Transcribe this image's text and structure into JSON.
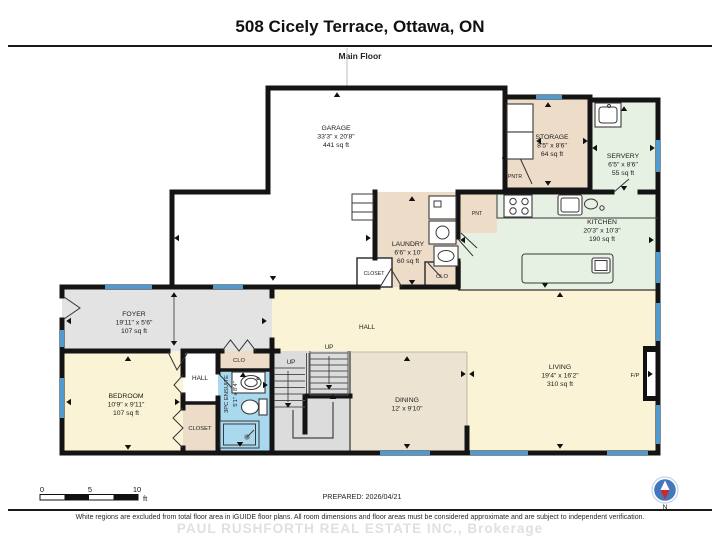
{
  "header": {
    "title": "508 Cicely Terrace, Ottawa, ON",
    "floor_label": "Main Floor"
  },
  "rooms": {
    "garage": {
      "name": "GARAGE",
      "dims": "33'3\" x 20'8\"",
      "area": "441 sq ft"
    },
    "storage": {
      "name": "STORAGE",
      "dims": "8'5\" x 8'6\"",
      "area": "64 sq ft"
    },
    "servery": {
      "name": "SERVERY",
      "dims": "6'5\" x 8'6\"",
      "area": "55 sq ft"
    },
    "kitchen": {
      "name": "KITCHEN",
      "dims": "20'3\" x 10'3\"",
      "area": "190 sq ft"
    },
    "laundry": {
      "name": "LAUNDRY",
      "dims": "6'6\" x 10'",
      "area": "60 sq ft"
    },
    "foyer": {
      "name": "FOYER",
      "dims": "19'11\" x 5'6\"",
      "area": "107 sq ft"
    },
    "bedroom": {
      "name": "BEDROOM",
      "dims": "10'9\" x 9'11\"",
      "area": "107 sq ft"
    },
    "dining": {
      "name": "DINING",
      "dims": "12' x 9'10\""
    },
    "living": {
      "name": "LIVING",
      "dims": "19'4\" x 16'2\"",
      "area": "310 sq ft"
    },
    "ensuite": {
      "name": "3PC ENSUITE",
      "dims": "5'1\" x 8'4\""
    }
  },
  "labels": {
    "hall_bedroom": "HALL",
    "hall_main": "HALL",
    "closet_bedroom": "CLOSET",
    "closet_laundry": "CLOSET",
    "clo_bedroom": "CLO",
    "clo_kitchen": "CLO",
    "pantry_storage": "PNTR",
    "pantry_kitchen": "PNT",
    "fireplace": "F/P",
    "stairs_up_left": "UP",
    "stairs_up_right": "UP"
  },
  "scale_bar": {
    "ticks": [
      "0",
      "5",
      "10"
    ],
    "unit": "ft"
  },
  "prepared": "PREPARED: 2026/04/21",
  "compass": {
    "north_label": "N"
  },
  "footer": {
    "disclaimer": "White regions are excluded from total floor area in iGUIDE floor plans. All room dimensions and floor areas must be considered approximate and are subject to independent verification.",
    "watermark": "PAUL RUSHFORTH REAL ESTATE INC., Brokerage"
  },
  "colors": {
    "wall": "#141414",
    "window": "#4e9bd2",
    "room_white": "#ffffff",
    "room_cream": "#fbf3d5",
    "room_tan": "#ecdcc8",
    "dining_tan": "#ece3d2",
    "room_green": "#e6f1e4",
    "room_gray": "#e3e3e3",
    "stairs_gray": "#dcdcdc",
    "room_blue": "#a9d9ef",
    "compass_blue": "#4277bd",
    "compass_red": "#cc2a27"
  }
}
